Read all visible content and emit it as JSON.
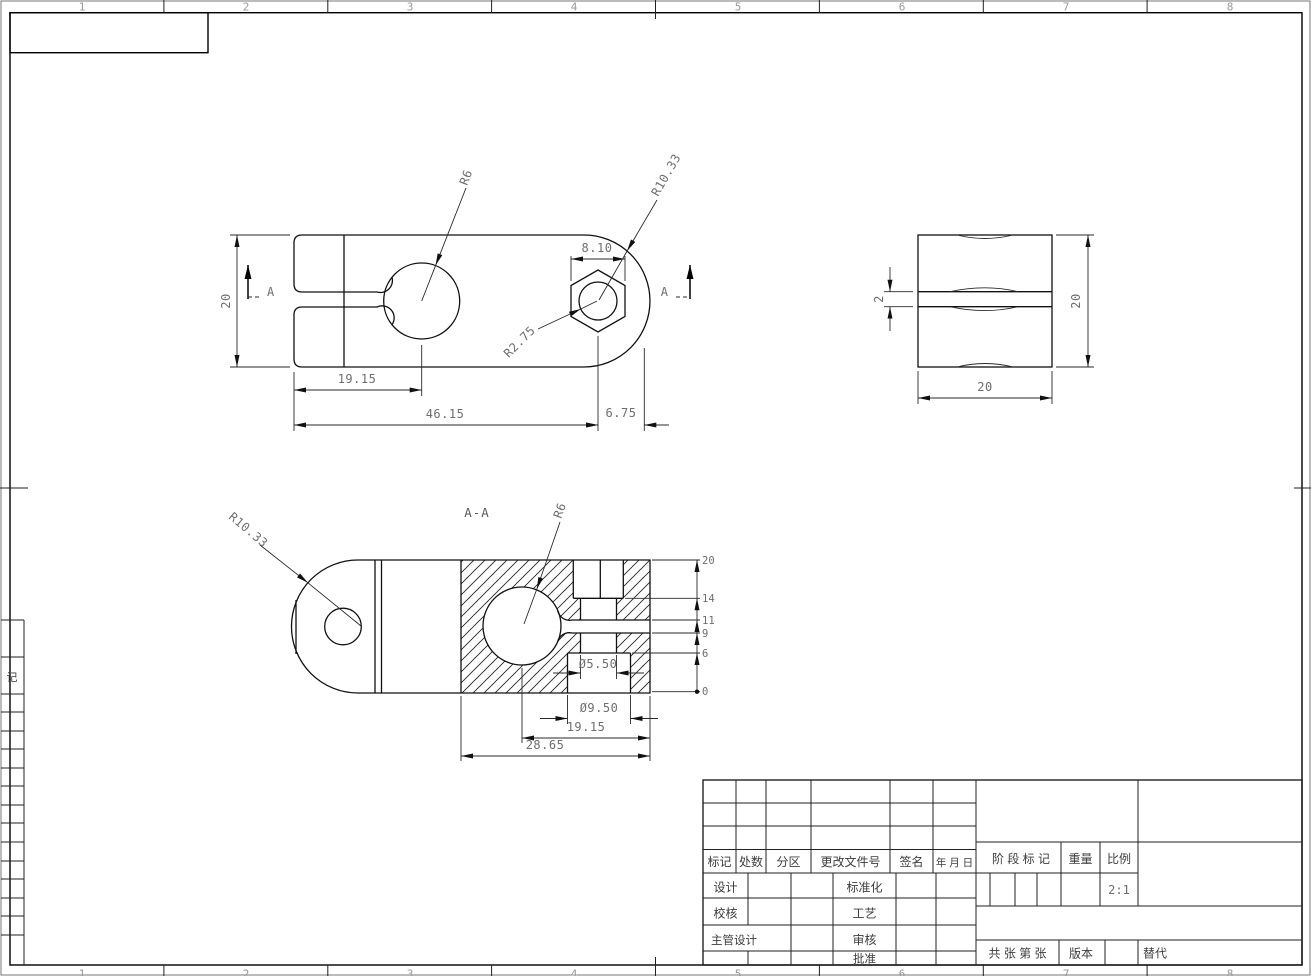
{
  "sheet": {
    "zones": [
      "1",
      "2",
      "3",
      "4",
      "5",
      "6",
      "7",
      "8"
    ],
    "strip_char": "记"
  },
  "top_view": {
    "radius_hole": "R6",
    "radius_end": "R10.33",
    "radius_hex_hole": "R2.75",
    "dim_hex_flats": "8.10",
    "dim_height": "20",
    "dim_hole_offset": "19.15",
    "dim_total": "46.15",
    "dim_end_offset": "6.75",
    "section_letter": "A"
  },
  "side_view": {
    "dim_slot": "2",
    "dim_height": "20",
    "dim_width": "20"
  },
  "section_view": {
    "title": "A-A",
    "radius_end": "R10.33",
    "radius_hole": "R6",
    "dia_hole": "Ø5.50",
    "dia_counterbore": "Ø9.50",
    "dim_hole_offset": "19.15",
    "dim_block": "28.65",
    "ordinates": [
      "20",
      "14",
      "11",
      "9",
      "6",
      "0"
    ]
  },
  "title_block": {
    "rev_headers": [
      "标记",
      "处数",
      "分区",
      "更改文件号",
      "签名",
      "年 月 日"
    ],
    "sig_rows": [
      {
        "left": "设计",
        "right": "标准化"
      },
      {
        "left": "校核",
        "right": "工艺"
      },
      {
        "left": "主管设计",
        "right": "审核"
      },
      {
        "left": "",
        "right": "批准"
      }
    ],
    "stage_label": "阶 段 标 记",
    "weight_label": "重量",
    "scale_label": "比例",
    "scale_value": "2:1",
    "sheets_label": "共  张 第  张",
    "version_label": "版本",
    "replace_label": "替代"
  }
}
